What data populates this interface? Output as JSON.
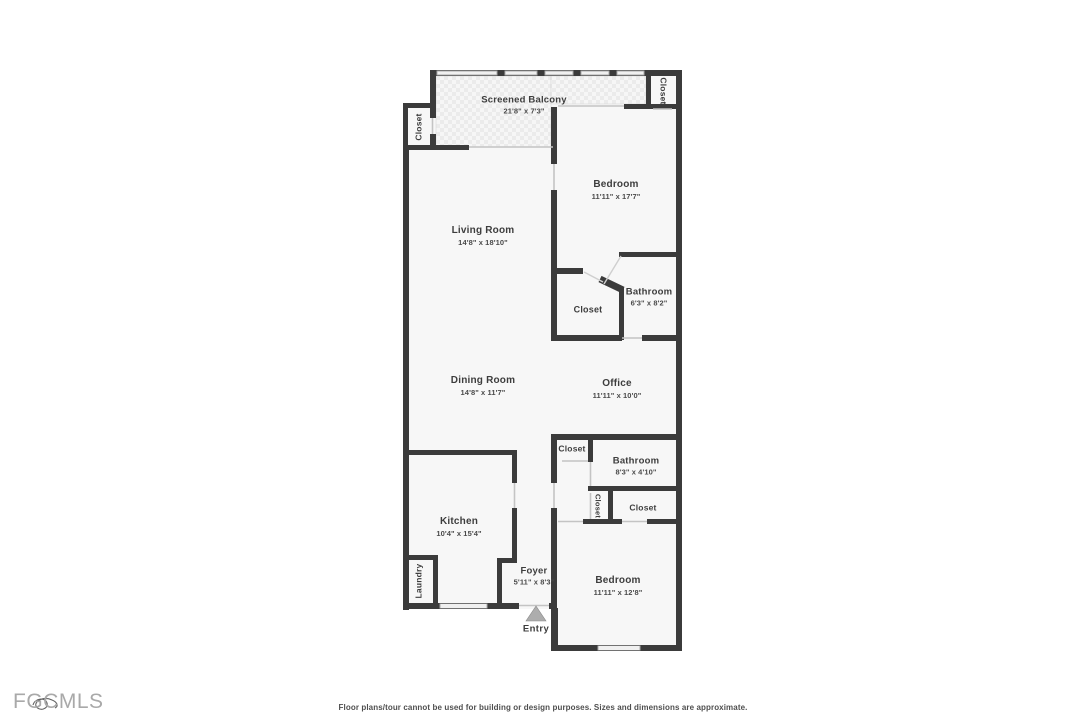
{
  "plan": {
    "rooms": {
      "screened_balcony": {
        "label": "Screened Balcony",
        "dims": "21'8\" x 7'3\""
      },
      "closet_top_left": {
        "label": "Closet"
      },
      "closet_top_right": {
        "label": "Closet"
      },
      "bedroom_1": {
        "label": "Bedroom",
        "dims": "11'11\" x 17'7\""
      },
      "living_room": {
        "label": "Living Room",
        "dims": "14'8\" x 18'10\""
      },
      "bathroom_1": {
        "label": "Bathroom",
        "dims": "6'3\" x 8'2\""
      },
      "closet_bedroom_1": {
        "label": "Closet"
      },
      "dining_room": {
        "label": "Dining Room",
        "dims": "14'8\" x 11'7\""
      },
      "office": {
        "label": "Office",
        "dims": "11'11\" x 10'0\""
      },
      "closet_hall": {
        "label": "Closet"
      },
      "bathroom_2": {
        "label": "Bathroom",
        "dims": "8'3\" x 4'10\""
      },
      "closet_hall_small": {
        "label": "Closet"
      },
      "closet_bedroom_2": {
        "label": "Closet"
      },
      "kitchen": {
        "label": "Kitchen",
        "dims": "10'4\" x 15'4\""
      },
      "laundry": {
        "label": "Laundry"
      },
      "foyer": {
        "label": "Foyer",
        "dims": "5'11\" x 8'3\""
      },
      "bedroom_2": {
        "label": "Bedroom",
        "dims": "11'11\" x 12'8\""
      },
      "entry": {
        "label": "Entry"
      }
    }
  },
  "footer": {
    "logo": "FGCMLS",
    "disclaimer": "Floor plans/tour cannot be used for building or design purposes. Sizes and dimensions are approximate."
  },
  "colors": {
    "wall": "#3b3b3b",
    "floor": "#f7f7f7",
    "tile": "#ececec",
    "entry_arrow": "#adadad"
  }
}
